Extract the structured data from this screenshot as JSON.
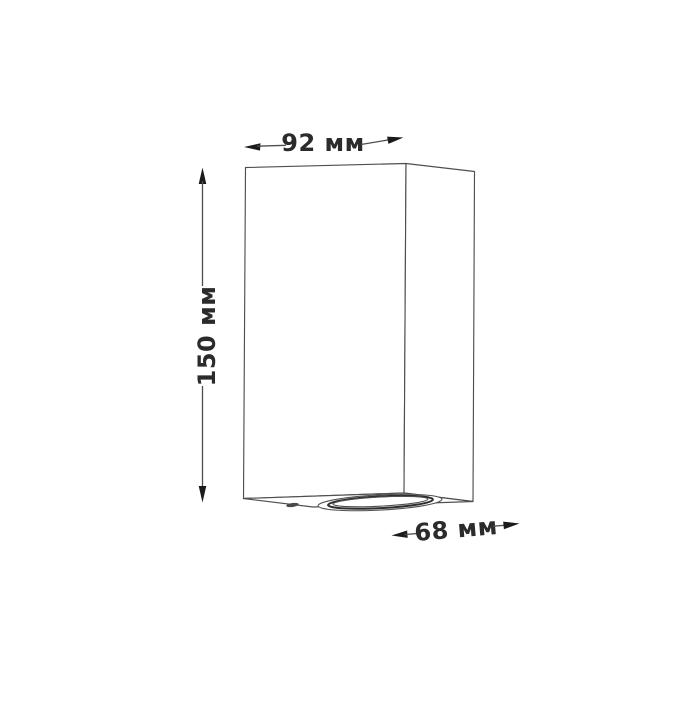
{
  "diagram": {
    "dimensions": {
      "width": {
        "label": "92 мм",
        "value": 92,
        "unit": "мм"
      },
      "height": {
        "label": "150 мм",
        "value": 150,
        "unit": "мм"
      },
      "depth": {
        "label": "68 мм",
        "value": 68,
        "unit": "мм"
      }
    },
    "colors": {
      "background": "#ffffff",
      "outline": "#4f4f4f",
      "dimension_line": "#4f4f4f",
      "arrowhead": "#1b1b1b",
      "label_text": "#2b2b2b"
    }
  }
}
